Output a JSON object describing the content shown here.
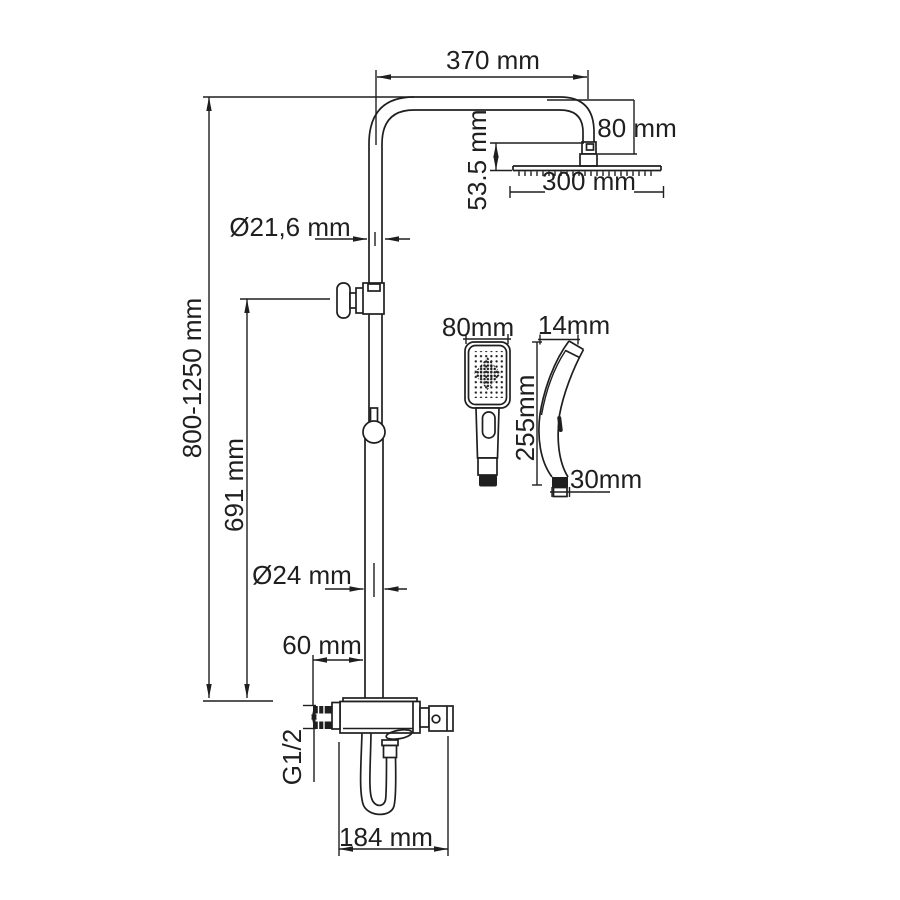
{
  "diagram": {
    "title_semantic": "shower-system-dimension-drawing",
    "colors": {
      "line": "#1f1f1f",
      "background": "#ffffff"
    },
    "dims": {
      "arm_reach": "370 mm",
      "arm_drop": "80 mm",
      "head_offset": "53.5 mm",
      "head_width": "300 mm",
      "upper_pipe_diameter": "Ø21,6 mm",
      "column_height_range": "800-1250 mm",
      "slide_height": "691 mm",
      "lower_pipe_diameter": "Ø24 mm",
      "valve_offset": "60 mm",
      "inlet_thread": "G1/2",
      "valve_width": "184 mm",
      "handshower_width": "80mm",
      "handshower_tip_depth": "14mm",
      "handshower_length": "255mm",
      "handshower_base_depth": "30mm"
    }
  }
}
